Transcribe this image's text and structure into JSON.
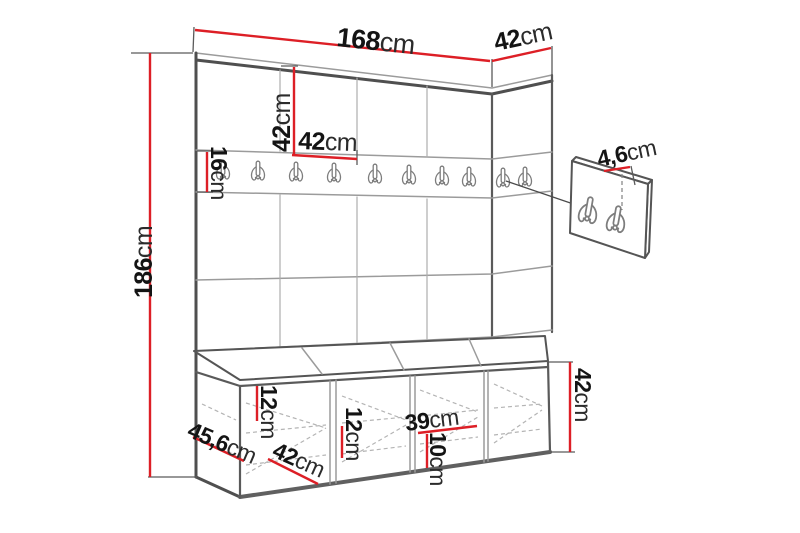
{
  "drawing": {
    "kind": "furniture-dimension-diagram",
    "subject": "hallway wall-panel unit with hook rail and storage bench",
    "units": "cm",
    "colors": {
      "dimension_line": "#dd1f26",
      "outline": "#4f4f4f",
      "seam": "#9b9b9b",
      "background": "#ffffff"
    }
  },
  "labels": {
    "total_width": {
      "num": "168",
      "unit": "cm"
    },
    "top_depth": {
      "num": "42",
      "unit": "cm"
    },
    "total_height": {
      "num": "186",
      "unit": "cm"
    },
    "panel_height": {
      "num": "42",
      "unit": "cm"
    },
    "panel_width": {
      "num": "42",
      "unit": "cm"
    },
    "rail_height": {
      "num": "16",
      "unit": "cm"
    },
    "hook_panel_thickness": {
      "num": "4,6",
      "unit": "cm"
    },
    "bench_top_height": {
      "num": "12",
      "unit": "cm"
    },
    "bench_shelf_height": {
      "num": "12",
      "unit": "cm"
    },
    "bench_compartment_width": {
      "num": "39",
      "unit": "cm"
    },
    "bench_compartment_height": {
      "num": "10",
      "unit": "cm"
    },
    "bench_depth": {
      "num": "45,6",
      "unit": "cm"
    },
    "bench_section_width": {
      "num": "42",
      "unit": "cm"
    },
    "bench_height": {
      "num": "42",
      "unit": "cm"
    }
  },
  "structure": {
    "wall_panel_columns_front": 4,
    "wall_panel_columns_side": 1,
    "wall_panel_rows": 3,
    "rail_hook_count": 10,
    "detail_panel_hook_count": 2,
    "bench_sections": 4,
    "bench_cushions": 4
  }
}
